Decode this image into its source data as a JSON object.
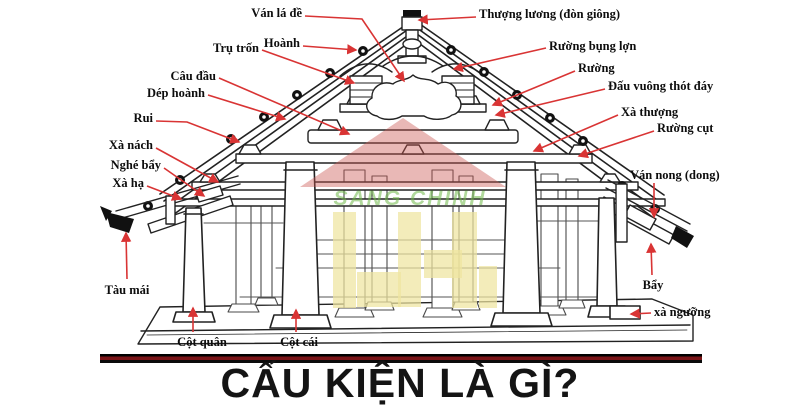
{
  "title": {
    "text": "CẤU KIỆN LÀ GÌ?",
    "color": "#141414"
  },
  "separator": {
    "color_outer": "#000000",
    "color_inner": "#7a1417"
  },
  "watermark": {
    "text": "SANG CHINH",
    "roof_color": "rgba(203,85,82,0.42)",
    "text_color": "rgba(112,184,72,0.55)",
    "block_color": "rgba(238,229,160,0.72)"
  },
  "colors": {
    "leader_line": "#d93434",
    "drawing": "#222222",
    "background": "#ffffff"
  },
  "labels": [
    {
      "id": "van-la-de",
      "text": "Ván lá đề",
      "x": 302,
      "y": 6,
      "align": "right",
      "line": [
        [
          305,
          16
        ],
        [
          362,
          19
        ],
        [
          404,
          81
        ]
      ]
    },
    {
      "id": "thuong-luong",
      "text": "Thượng lương (đòn giông)",
      "x": 479,
      "y": 7,
      "align": "left",
      "line": [
        [
          476,
          17
        ],
        [
          419,
          20
        ]
      ]
    },
    {
      "id": "tru-tron",
      "text": "Trụ trốn",
      "x": 259,
      "y": 41,
      "align": "right",
      "line": [
        [
          262,
          50
        ],
        [
          354,
          83
        ]
      ]
    },
    {
      "id": "hoanh",
      "text": "Hoành",
      "x": 300,
      "y": 36,
      "align": "right",
      "line": [
        [
          303,
          46
        ],
        [
          356,
          50
        ]
      ]
    },
    {
      "id": "cau-dau",
      "text": "Câu đầu",
      "x": 216,
      "y": 69,
      "align": "right",
      "line": [
        [
          219,
          78
        ],
        [
          349,
          134
        ]
      ]
    },
    {
      "id": "dep-hoanh",
      "text": "Dép hoành",
      "x": 205,
      "y": 86,
      "align": "right",
      "line": [
        [
          208,
          95
        ],
        [
          285,
          119
        ]
      ]
    },
    {
      "id": "ruong-bung-lon",
      "text": "Rường bụng lợn",
      "x": 549,
      "y": 39,
      "align": "left",
      "line": [
        [
          546,
          48
        ],
        [
          454,
          69
        ]
      ]
    },
    {
      "id": "ruong",
      "text": "Rường",
      "x": 578,
      "y": 61,
      "align": "left",
      "line": [
        [
          575,
          71
        ],
        [
          493,
          105
        ]
      ]
    },
    {
      "id": "dau-vuong",
      "text": "Đấu vuông thót đáy",
      "x": 608,
      "y": 79,
      "align": "left",
      "line": [
        [
          605,
          89
        ],
        [
          496,
          115
        ]
      ]
    },
    {
      "id": "xa-thuong",
      "text": "Xà thượng",
      "x": 621,
      "y": 105,
      "align": "left",
      "line": [
        [
          618,
          115
        ],
        [
          534,
          151
        ]
      ]
    },
    {
      "id": "ruong-cut",
      "text": "Rường cụt",
      "x": 657,
      "y": 121,
      "align": "left",
      "line": [
        [
          654,
          131
        ],
        [
          579,
          156
        ]
      ]
    },
    {
      "id": "rui",
      "text": "Rui",
      "x": 153,
      "y": 111,
      "align": "right",
      "line": [
        [
          156,
          121
        ],
        [
          187,
          122
        ],
        [
          239,
          142
        ]
      ]
    },
    {
      "id": "xa-nach",
      "text": "Xà nách",
      "x": 153,
      "y": 138,
      "align": "right",
      "line": [
        [
          156,
          148
        ],
        [
          218,
          182
        ]
      ]
    },
    {
      "id": "nghe-bay",
      "text": "Nghé bẩy",
      "x": 161,
      "y": 158,
      "align": "right",
      "line": [
        [
          164,
          168
        ],
        [
          204,
          196
        ]
      ]
    },
    {
      "id": "xa-ha",
      "text": "Xà hạ",
      "x": 144,
      "y": 176,
      "align": "right",
      "line": [
        [
          147,
          186
        ],
        [
          181,
          199
        ]
      ]
    },
    {
      "id": "tau-mai",
      "text": "Tàu mái",
      "x": 127,
      "y": 283,
      "align": "center",
      "line": [
        [
          127,
          279
        ],
        [
          126,
          233
        ]
      ]
    },
    {
      "id": "van-nong",
      "text": "Ván nong (dong)",
      "x": 630,
      "y": 168,
      "align": "left",
      "line": [
        [
          654,
          183
        ],
        [
          654,
          217
        ]
      ]
    },
    {
      "id": "bay",
      "text": "Bẩy",
      "x": 653,
      "y": 278,
      "align": "center",
      "line": [
        [
          652,
          275
        ],
        [
          651,
          244
        ]
      ]
    },
    {
      "id": "xa-nguong",
      "text": "xà ngưỡng",
      "x": 654,
      "y": 305,
      "align": "left",
      "line": [
        [
          651,
          313
        ],
        [
          631,
          314
        ]
      ]
    },
    {
      "id": "cot-quan",
      "text": "Cột quân",
      "x": 202,
      "y": 335,
      "align": "center",
      "line": [
        [
          193,
          332
        ],
        [
          193,
          308
        ]
      ]
    },
    {
      "id": "cot-cai",
      "text": "Cột cái",
      "x": 299,
      "y": 335,
      "align": "center",
      "line": [
        [
          296,
          332
        ],
        [
          296,
          310
        ]
      ]
    }
  ]
}
